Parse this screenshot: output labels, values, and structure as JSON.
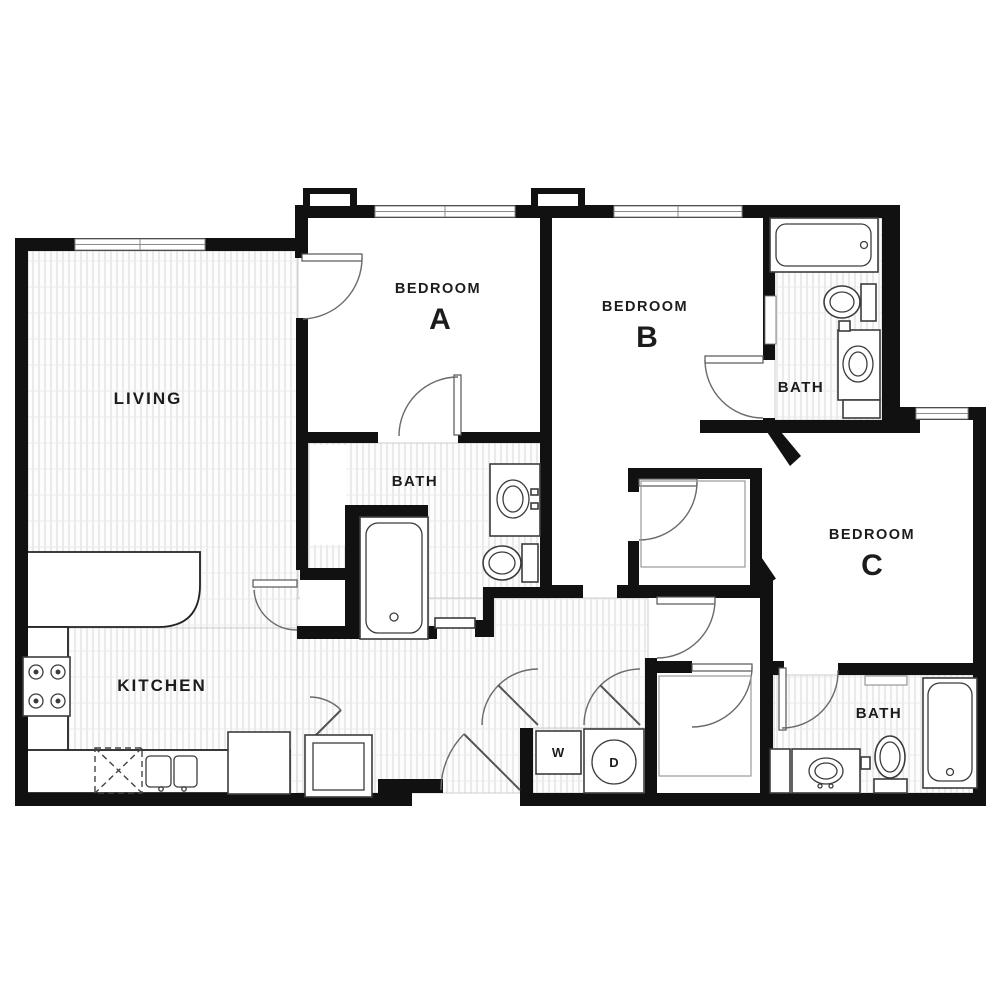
{
  "plan": {
    "type": "apartment-floor-plan",
    "rooms": {
      "living": {
        "label": "LIVING"
      },
      "kitchen": {
        "label": "KITCHEN"
      },
      "bedroom_a": {
        "label": "BEDROOM",
        "letter": "A"
      },
      "bedroom_b": {
        "label": "BEDROOM",
        "letter": "B"
      },
      "bedroom_c": {
        "label": "BEDROOM",
        "letter": "C"
      },
      "bath_a": {
        "label": "BATH"
      },
      "bath_b": {
        "label": "BATH"
      },
      "bath_c": {
        "label": "BATH"
      },
      "laundry": {
        "washer": "W",
        "dryer": "D"
      }
    },
    "fixtures": [
      "bathtub-a",
      "bathtub-b",
      "bathtub-c",
      "toilet-a",
      "toilet-b",
      "toilet-c",
      "sink-vanity-a",
      "sink-vanity-b",
      "sink-vanity-c",
      "stove",
      "kitchen-sink",
      "refrigerator",
      "dishwasher",
      "pantry-cabinet",
      "washer",
      "dryer"
    ],
    "colors": {
      "wall": "#111111",
      "fixture_stroke": "#3c3c3c",
      "door_stroke": "#6a6a6a",
      "hatch_line": "#d7d7d7",
      "label": "#1c1c1c",
      "background": "#ffffff"
    }
  }
}
